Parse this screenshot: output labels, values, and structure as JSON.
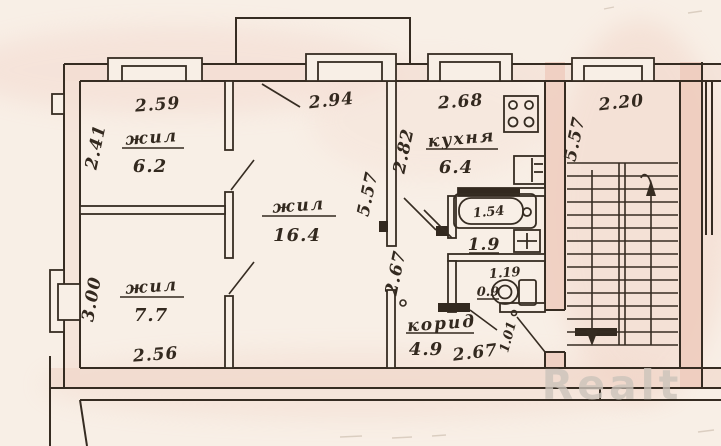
{
  "watermark": "Realt",
  "rooms": {
    "living_small": {
      "name": "жил",
      "area": "6.2",
      "width": "2.59",
      "height": "2.41"
    },
    "living_main": {
      "name": "жил",
      "area": "16.4",
      "width": "2.94",
      "height": "5.57",
      "passage_height": "2.67"
    },
    "living_lower": {
      "name": "жил",
      "area": "7.7",
      "width": "2.56",
      "height": "3.00"
    },
    "kitchen": {
      "name": "кухня",
      "area": "6.4",
      "width": "2.68",
      "height": "2.82"
    },
    "bathroom": {
      "area": "1.9",
      "bathtub_length": "1.54"
    },
    "wc": {
      "area": "0.9",
      "width": "1.19"
    },
    "corridor": {
      "name": "корид",
      "area": "4.9",
      "width": "2.67",
      "entry_door_width": "1.01"
    },
    "stairwell": {
      "width": "2.20",
      "height": "5.57"
    }
  }
}
